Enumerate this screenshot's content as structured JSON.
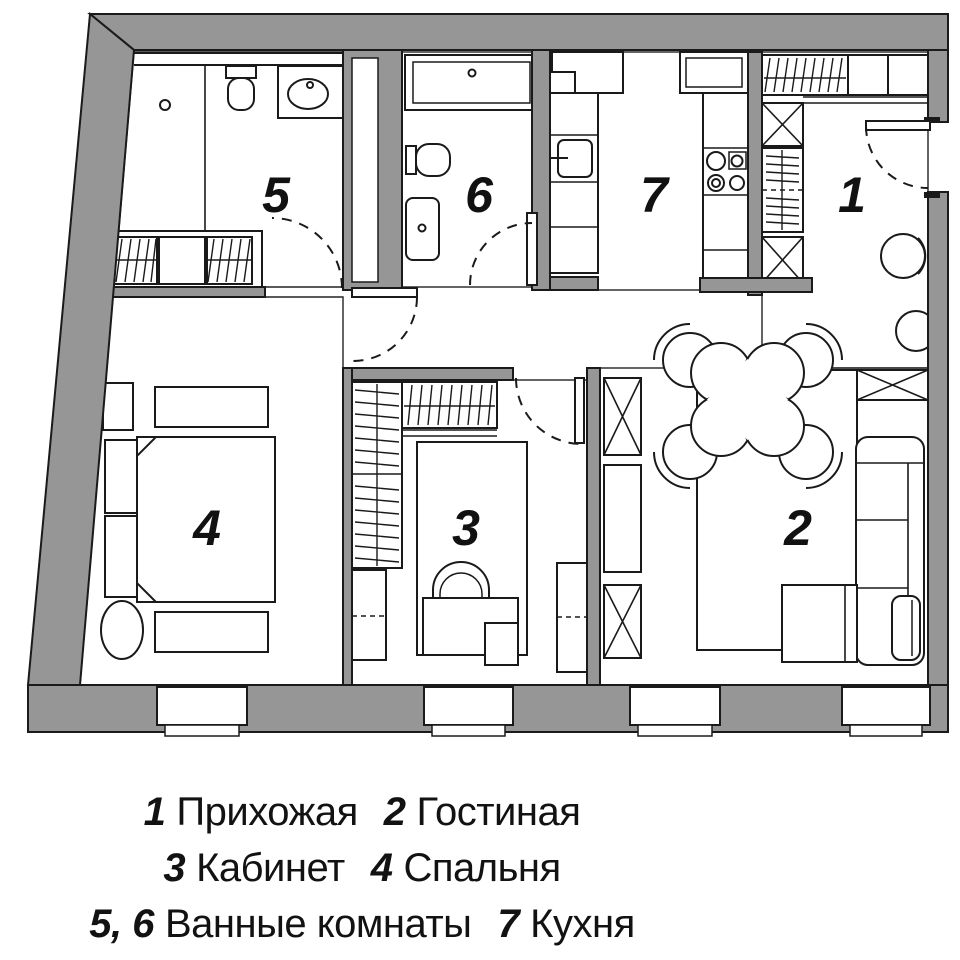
{
  "plan": {
    "background": "#ffffff",
    "wall_color": "#969696",
    "line_color": "#1a1a1a",
    "room_labels": [
      "1",
      "2",
      "3",
      "4",
      "5",
      "6",
      "7"
    ],
    "rooms": [
      {
        "number": "1",
        "name": "Прихожая"
      },
      {
        "number": "2",
        "name": "Гостиная"
      },
      {
        "number": "3",
        "name": "Кабинет"
      },
      {
        "number": "4",
        "name": "Спальня"
      },
      {
        "number": "5",
        "name": "Ванные комнаты"
      },
      {
        "number": "6",
        "name": "Ванные комнаты"
      },
      {
        "number": "7",
        "name": "Кухня"
      }
    ]
  },
  "legend": {
    "line1": {
      "n1": "1",
      "t1": "Прихожая",
      "n2": "2",
      "t2": "Гостиная"
    },
    "line2": {
      "n1": "3",
      "t1": "Кабинет",
      "n2": "4",
      "t2": "Спальня"
    },
    "line3": {
      "n1": "5, 6",
      "t1": "Ванные комнаты",
      "n2": "7",
      "t2": "Кухня"
    }
  }
}
